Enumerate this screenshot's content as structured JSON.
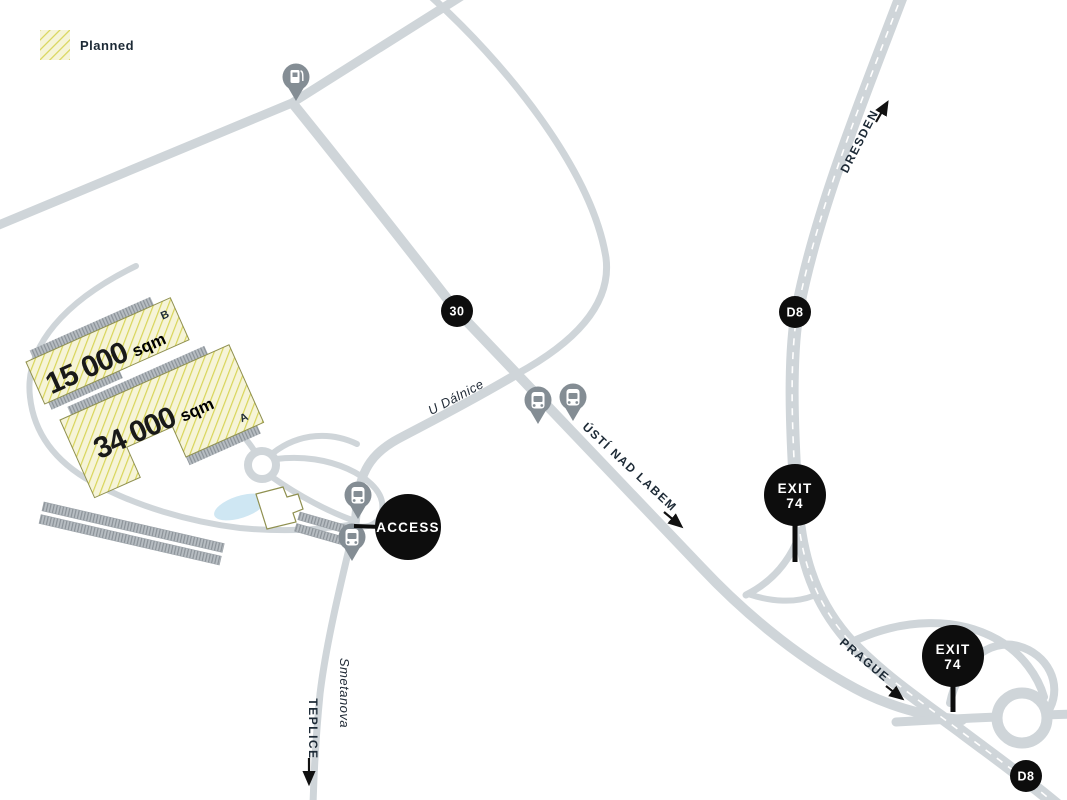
{
  "legend": {
    "planned_label": "Planned"
  },
  "buildings": {
    "b": {
      "area": "15 000",
      "unit": "sqm",
      "letter": "B"
    },
    "a": {
      "area": "34 000",
      "unit": "sqm",
      "letter": "A"
    }
  },
  "roads": {
    "u_dalnice": "U Dálnice",
    "smetanova": "Smetanova"
  },
  "destinations": {
    "teplice": "TEPLICE",
    "usti_nad_labem": "ÚSTÍ NAD LABEM",
    "dresden": "DRESDEN",
    "prague": "PRAGUE"
  },
  "badges": {
    "route_30": "30",
    "d8_north": "D8",
    "d8_south": "D8"
  },
  "markers": {
    "access": "ACCESS",
    "exit_north": {
      "line1": "EXIT",
      "line2": "74"
    },
    "exit_south": {
      "line1": "EXIT",
      "line2": "74"
    }
  },
  "icons": {
    "bus_stop": "bus-stop-pin",
    "fuel_station": "fuel-station-pin"
  },
  "colors": {
    "road": "#cfd5d9",
    "planned_fill": "#f6f4d8",
    "planned_hatch": "#d8d559",
    "marker_black": "#0d0d0d",
    "text_dark": "#1d2a36",
    "pin_gray": "#848d94",
    "pond_blue": "#cfe7f3"
  }
}
